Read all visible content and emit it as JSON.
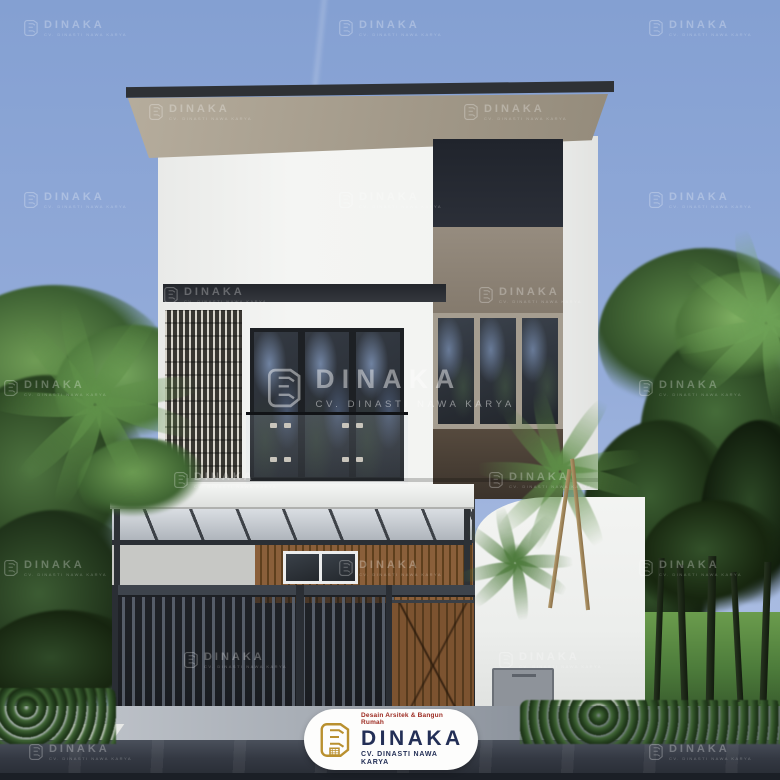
{
  "alt_text": "3D architectural render of a modern two-storey minimalist house with dark flat roof, slatted screen, glass balcony, carport with bar gate, palm trees and DINAKA watermarks",
  "branding": {
    "watermark": {
      "label": "DINAKA",
      "subline": "CV. DINASTI NAWA KARYA"
    },
    "logo_badge": {
      "tagline": "Desain Arsitek & Bangun Rumah",
      "name": "DINAKA",
      "company": "CV. DINASTI NAWA KARYA"
    }
  },
  "palette": {
    "sky_top": "#84a0d2",
    "sky_bottom": "#b6c6e7",
    "roof_fascia": "#2e3135",
    "roof_underside": "#a39a8a",
    "wall_white": "#f2f3f1",
    "panel_dark": "#262a32",
    "panel_taupe": "#8b8175",
    "glass": "#2b3037",
    "glass_reflection": "#8096ba",
    "wood": "#7c5330",
    "gate_metal": "#565d68",
    "lawn": "#4d7c3b",
    "road": "#343943",
    "logo_gold": "#b9902f",
    "logo_navy": "#232f56",
    "logo_red": "#9c2a20",
    "watermark_opacity": 0.28
  },
  "scene": {
    "watermarks": [
      {
        "x": 75,
        "y": 28,
        "s": 1
      },
      {
        "x": 390,
        "y": 28,
        "s": 1
      },
      {
        "x": 700,
        "y": 28,
        "s": 1
      },
      {
        "x": 200,
        "y": 112,
        "s": 1
      },
      {
        "x": 515,
        "y": 112,
        "s": 1
      },
      {
        "x": 75,
        "y": 200,
        "s": 1
      },
      {
        "x": 390,
        "y": 200,
        "s": 1
      },
      {
        "x": 700,
        "y": 200,
        "s": 1
      },
      {
        "x": 215,
        "y": 295,
        "s": 1
      },
      {
        "x": 530,
        "y": 295,
        "s": 1
      },
      {
        "x": 55,
        "y": 388,
        "s": 1
      },
      {
        "x": 390,
        "y": 388,
        "s": 2.4,
        "big": true
      },
      {
        "x": 690,
        "y": 388,
        "s": 1
      },
      {
        "x": 225,
        "y": 480,
        "s": 1
      },
      {
        "x": 540,
        "y": 480,
        "s": 1
      },
      {
        "x": 55,
        "y": 568,
        "s": 1
      },
      {
        "x": 390,
        "y": 568,
        "s": 1
      },
      {
        "x": 690,
        "y": 568,
        "s": 1
      },
      {
        "x": 235,
        "y": 660,
        "s": 1
      },
      {
        "x": 550,
        "y": 660,
        "s": 1
      },
      {
        "x": 80,
        "y": 752,
        "s": 1
      },
      {
        "x": 390,
        "y": 752,
        "s": 1
      },
      {
        "x": 700,
        "y": 752,
        "s": 1
      }
    ],
    "foliage": [
      {
        "x": -70,
        "y": 285,
        "w": 250,
        "h": 200,
        "c1": "#6f9c55",
        "c2": "#3b5e31",
        "front": false
      },
      {
        "x": -60,
        "y": 375,
        "w": 215,
        "h": 250,
        "c1": "#4e7440",
        "c2": "#27401f",
        "front": false
      },
      {
        "x": -45,
        "y": 510,
        "w": 200,
        "h": 220,
        "c1": "#3c5c33",
        "c2": "#1d2f18",
        "front": false
      },
      {
        "x": 55,
        "y": 325,
        "w": 160,
        "h": 130,
        "c1": "#74a45c",
        "c2": "#446b36",
        "front": false
      },
      {
        "x": -25,
        "y": 610,
        "w": 180,
        "h": 125,
        "c1": "#2f4a28",
        "c2": "#16240f",
        "front": false
      },
      {
        "x": 78,
        "y": 438,
        "w": 130,
        "h": 90,
        "c1": "#6f9e55",
        "c2": "#3f6532",
        "front": true
      },
      {
        "x": 598,
        "y": 248,
        "w": 215,
        "h": 180,
        "c1": "#5d8a49",
        "c2": "#33512a",
        "front": false
      },
      {
        "x": 640,
        "y": 330,
        "w": 180,
        "h": 215,
        "c1": "#456c39",
        "c2": "#243c1d",
        "front": false
      },
      {
        "x": 582,
        "y": 420,
        "w": 160,
        "h": 200,
        "c1": "#3a5c30",
        "c2": "#1c2f15",
        "front": false
      },
      {
        "x": 675,
        "y": 272,
        "w": 145,
        "h": 120,
        "c1": "#7fb062",
        "c2": "#4a7239",
        "front": false
      },
      {
        "x": 598,
        "y": 555,
        "w": 125,
        "h": 120,
        "c1": "#2e4a26",
        "c2": "#142110",
        "front": false
      },
      {
        "x": 700,
        "y": 420,
        "w": 120,
        "h": 210,
        "c1": "#2c4725",
        "c2": "#101c0c",
        "front": false
      },
      {
        "x": 640,
        "y": 500,
        "w": 150,
        "h": 130,
        "c1": "#33512a",
        "c2": "#17260f",
        "front": false
      }
    ],
    "palm_crowns": [
      {
        "cx": 560,
        "cy": 462,
        "r": 88,
        "n": 9,
        "c": "#5d8c47"
      },
      {
        "cx": 515,
        "cy": 556,
        "r": 62,
        "n": 8,
        "c": "#4f7c3e"
      },
      {
        "cx": 95,
        "cy": 392,
        "r": 112,
        "n": 9,
        "c": "#5f9049"
      },
      {
        "cx": 766,
        "cy": 312,
        "r": 102,
        "n": 8,
        "c": "#6da156"
      }
    ],
    "palm_trunks": [
      {
        "x": 548,
        "y": 468,
        "h": 140,
        "rot": 8
      },
      {
        "x": 586,
        "y": 458,
        "h": 152,
        "rot": -6
      }
    ],
    "lawn_trunks": [
      {
        "x": 656,
        "y": 558,
        "h": 150,
        "w": 6,
        "rot": 2
      },
      {
        "x": 679,
        "y": 565,
        "h": 142,
        "w": 7,
        "rot": -2
      },
      {
        "x": 707,
        "y": 556,
        "h": 152,
        "w": 8,
        "rot": 1
      },
      {
        "x": 734,
        "y": 572,
        "h": 130,
        "w": 6,
        "rot": -3
      },
      {
        "x": 762,
        "y": 562,
        "h": 142,
        "w": 7,
        "rot": 2
      }
    ]
  }
}
